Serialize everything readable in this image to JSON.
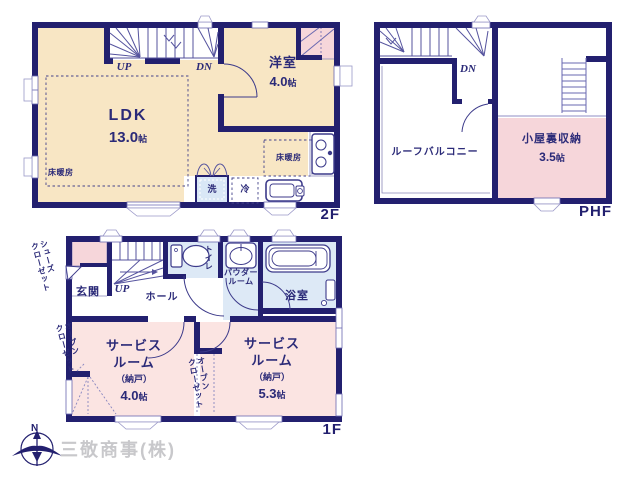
{
  "floor2": {
    "label": "2F",
    "stairs_up": "UP",
    "stairs_dn": "DN",
    "ldk": {
      "name": "LDK",
      "size_num": "13.0",
      "size_unit": "帖"
    },
    "yoshitsu": {
      "name": "洋室",
      "size_num": "4.0",
      "size_unit": "帖"
    },
    "floor_heating": "床暖房",
    "floor_heating_2": "床暖房",
    "washer": "洗",
    "fridge": "冷"
  },
  "phf": {
    "label": "PHF",
    "stairs_dn": "DN",
    "roof_balcony": "ルーフバルコニー",
    "attic": {
      "name": "小屋裏収納",
      "size_num": "3.5",
      "size_unit": "帖"
    }
  },
  "floor1": {
    "label": "1F",
    "stairs_up": "UP",
    "genkan": "玄関",
    "hall": "ホール",
    "toilet": "トイレ",
    "powder_l1": "パウダー",
    "powder_l2": "ルーム",
    "bath": "浴室",
    "shoes_closet_l1": "シューズ",
    "shoes_closet_l2": "クローゼット",
    "open_closet_left_l1": "オープン",
    "open_closet_left_l2": "クローゼット",
    "open_closet_mid_l1": "オープン",
    "open_closet_mid_l2": "クローゼット",
    "service1": {
      "l1": "サービス",
      "l2": "ルーム",
      "l3": "（納戸）",
      "size_num": "4.0",
      "size_unit": "帖"
    },
    "service2": {
      "l1": "サービス",
      "l2": "ルーム",
      "l3": "（納戸）",
      "size_num": "5.3",
      "size_unit": "帖"
    }
  },
  "footer": {
    "compass_n": "N",
    "company": "三敬商事(株)"
  },
  "colors": {
    "wall": "#23206f",
    "floor_cream": "#f8e6c4",
    "room_pink": "#fbe4e2",
    "closet_pink": "#f6d6da",
    "wet_blue": "#dde9f6",
    "thin_line": "#6a68b0",
    "text_navy": "#2b2a78",
    "company_gray": "#c8c8cb"
  }
}
